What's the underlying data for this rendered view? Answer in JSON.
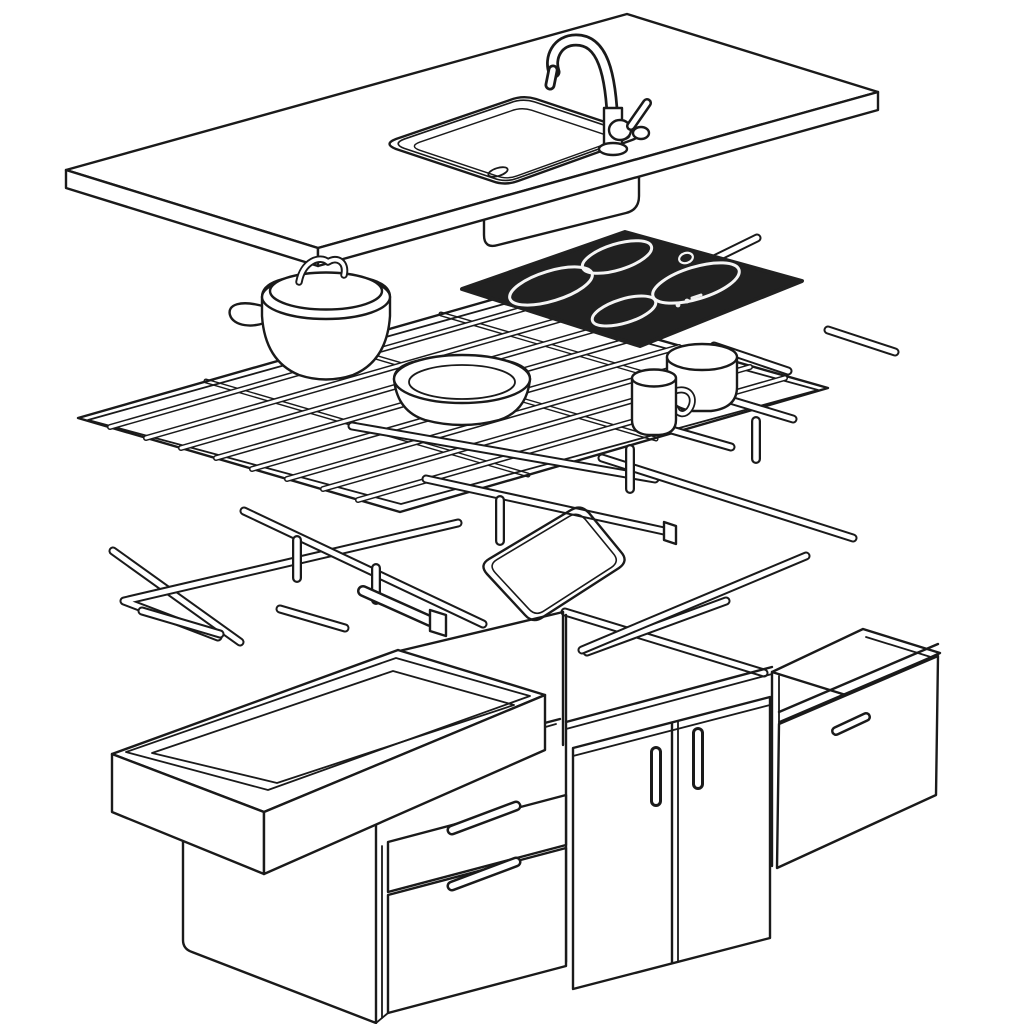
{
  "page": {
    "background": "#ffffff"
  },
  "diagram": {
    "kind": "exploded-isometric-line-drawing",
    "subject": "kitchen island assembly",
    "alt": "Exploded isometric line drawing of a kitchen island: countertop with sink cutout and gooseneck faucet; below it an induction cooktop, stock pot, pan and cups on a wire rack; below that support rails, pegs and a frame; at the bottom base cabinets with an open drawer box, drawer fronts, two doors and an end cabinet",
    "colors": {
      "line": "#1a1a1a",
      "fill": "#ffffff",
      "cooktop": "#212121",
      "burner_ring": "#f5f5f5"
    },
    "counts": {
      "burners": 4,
      "cabinet_doors": 2,
      "drawer_fronts": 2,
      "handles": 5
    },
    "parts": [
      "countertop-slab",
      "sink-cutout",
      "sink-basin",
      "gooseneck-faucet",
      "induction-cooktop",
      "burner-rings",
      "stock-pot",
      "saute-pan",
      "mug",
      "cup",
      "wire-rack",
      "support-rails",
      "dowel-pegs",
      "frame-outline",
      "support-beam",
      "open-drawer-box",
      "pedestal",
      "drawer-stack",
      "cabinet-doors",
      "door-handles",
      "end-cabinet"
    ]
  }
}
